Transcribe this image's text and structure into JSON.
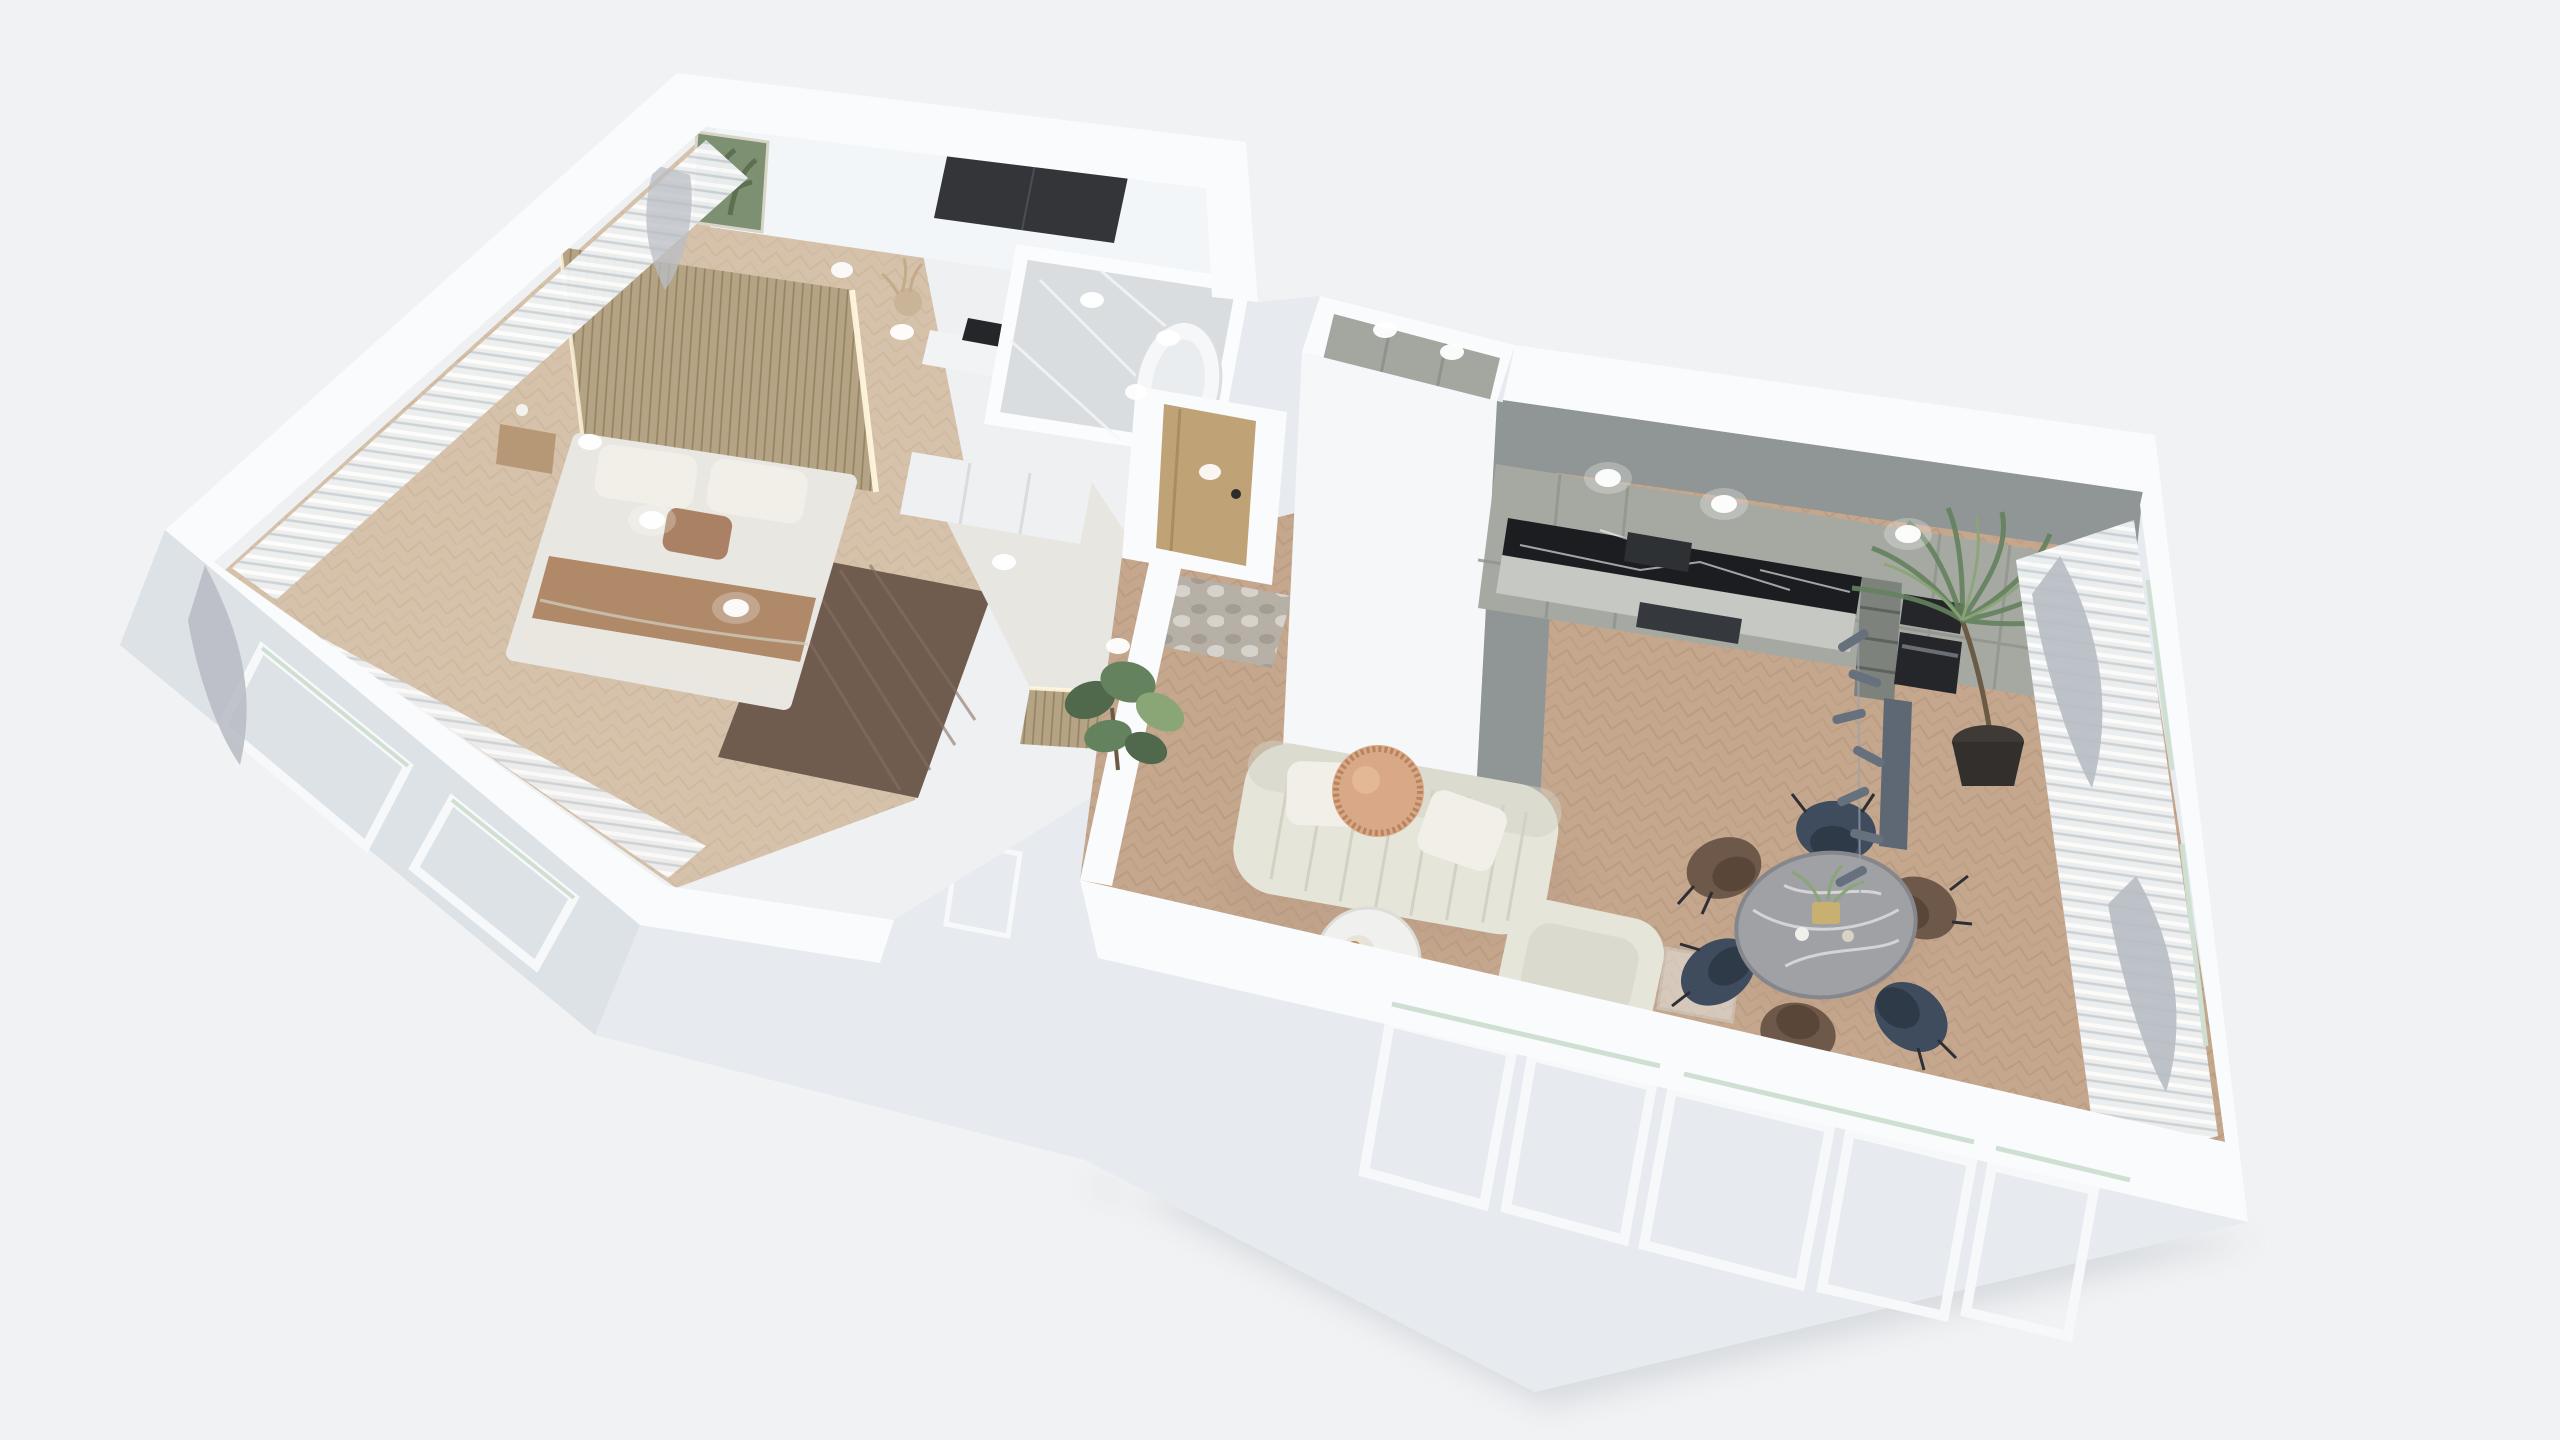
{
  "meta": {
    "kind": "3d-floor-plan-render",
    "view": "top-down axonometric cutaway of a one-bedroom apartment",
    "visible_text": "none"
  },
  "colors": {
    "bg": "#f1f2f4",
    "wallTop": "#f9fbfd",
    "wallFace": "#e7ebef",
    "wallFaceDark": "#dde2e6",
    "interiorBase": "#eef0f2",
    "woodFloor": "#c5a78e",
    "woodFloorDark": "#b09379",
    "bedroomFloor": "#d6c2ab",
    "bedroomFloorDark": "#c5ad92",
    "darkWood": "#6f5c4f",
    "darkWoodGrain": "#857060",
    "slat": "#b5a385",
    "slatDark": "#94835f",
    "marble": "#d9dde0",
    "marbleVein": "#f4f6f8",
    "kitchenCab": "#a6a9a2",
    "kitchenCabSeam": "#8f938c",
    "kitchenWall": "#909695",
    "blackMarble": "#1b1d21",
    "counterTop": "#c6c8c3",
    "appliance": "#24262a",
    "sofa": "#e6e5da",
    "sofaShade": "#d2d1c4",
    "pillow": "#f1efe7",
    "duvet": "#e9e7e1",
    "blanket": "#b08968",
    "pillowAccent": "#aa8165",
    "tanTable": "#d9a987",
    "tanTableRim": "#b9835f",
    "diningTable": "#9fa1a5",
    "diningTableEdge": "#85878c",
    "chairNavy": "#3e4c5e",
    "chairNavySeat": "#2f3a49",
    "chairBrown": "#6d584a",
    "chairBrownSeat": "#5a4639",
    "chairLeg": "#2c2f33",
    "oakDoor": "#c0a277",
    "rugBase": "#b6b0a8",
    "rugDark": "#8e8880",
    "plant": "#64825e",
    "plantDark": "#50684b",
    "plantLight": "#8aa576",
    "trunk": "#6b5b45",
    "sheer": "#eef1f3",
    "drape": "#b9bdc4",
    "pendant": "#5d6874",
    "pendantWire": "#9aa2ab",
    "art": "#7d9071",
    "artLeaf": "#5d7152",
    "nightstand": "#b69877",
    "lightDot": "#ffffff",
    "shadow": "#c9ced2",
    "glassRod": "#cfe0d2",
    "ledStrip": "#fff6dd",
    "windowFrame": "#f6f8fa",
    "tub": "#f5f7f8"
  },
  "scene": {
    "rooms": [
      {
        "name": "Bedroom",
        "features": "double bed with white duvet, brown blanket band, white pillows and one brown accent pillow; wood slat headboard wall with LED edge light; wood nightstand with lamp; light herringbone wood floor; dark wood floor walkway; sheer white curtains with gray drapes on two window walls; recessed ceiling lights"
      },
      {
        "name": "Dressing area",
        "features": "white desk with black laptop, dried pampas in vase, framed botanical art print, dark smoked-glass wardrobe"
      },
      {
        "name": "Bathroom",
        "features": "white-gray marble floor, freestanding white bathtub, white partition walls, recessed lights"
      },
      {
        "name": "Hallway",
        "features": "white wardrobe closet fronts, tan wood slat accent wall with LED strip, recessed lights, balcony opening"
      },
      {
        "name": "Entry",
        "features": "light oak entry door with black handle, gray abstract rug, recessed light"
      },
      {
        "name": "Utility closet",
        "features": "tall white volume with gray cabinets inside, marble floor, two recessed lights"
      },
      {
        "name": "Kitchen",
        "features": "sage-gray handleless cabinets, black marble backsplash, black cooker hood and cooktop, built-in black oven and microwave, open shelf column, tall cabinets, gray feature wall, downlights"
      },
      {
        "name": "Living room",
        "features": "cream channel-tufted 3-seat sofa with two white pillows, round tan fluted side table, round white coffee table with croissant plate, cream armchair, glass console, fiddle-leaf plant, areca palm in dark round planter, herringbone oak floor"
      },
      {
        "name": "Dining area",
        "features": "round gray marble dining table with gold centerpiece, six curved chairs (3 navy blue, 3 brown), slate linear pendant light, sheer curtains with gray tied drapes along window walls"
      }
    ],
    "counts": {
      "dining_chairs": 6,
      "navy_chairs": 3,
      "brown_chairs": 3,
      "bottom_wall_windows": 5,
      "left_wall_windows": 2,
      "downlights": 15
    },
    "materials": {
      "living_floor": "light oak herringbone",
      "bedroom_floor": "pale oak herringbone",
      "bathroom_floor": "white marble",
      "walls": "white cutaway walls viewed from above"
    }
  }
}
